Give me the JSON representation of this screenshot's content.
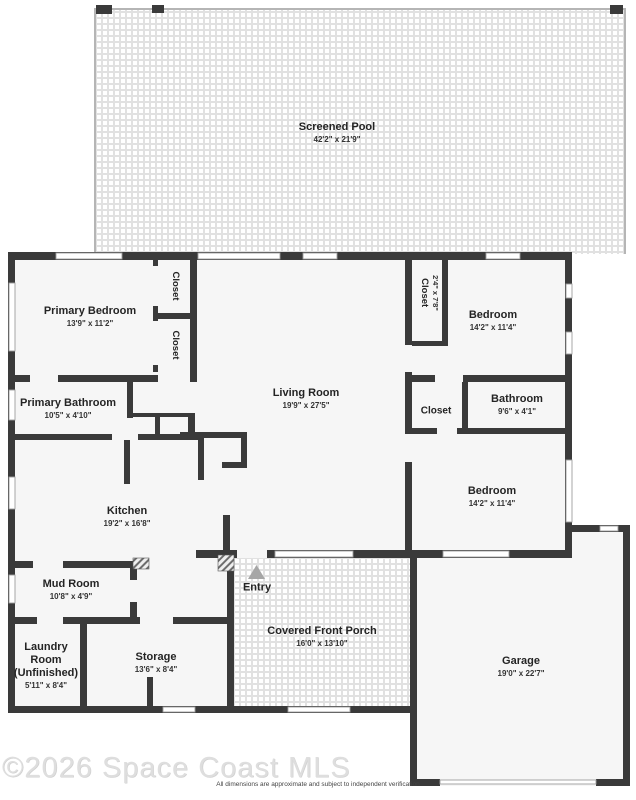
{
  "watermark": "©2026 Space Coast MLS",
  "disclaimer": "All dimensions are approximate and subject to independent verification",
  "rooms": {
    "pool": {
      "name": "Screened Pool",
      "dims": "42'2\" x 21'9\""
    },
    "primary_bedroom": {
      "name": "Primary Bedroom",
      "dims": "13'9\" x 11'2\""
    },
    "closet_primary_a": {
      "name": "Closet"
    },
    "closet_primary_b": {
      "name": "Closet"
    },
    "living_room": {
      "name": "Living Room",
      "dims": "19'9\" x 27'5\""
    },
    "closet_bedroom1": {
      "name": "Closet",
      "dims": "2'4\" x 7'8\""
    },
    "bedroom1": {
      "name": "Bedroom",
      "dims": "14'2\" x 11'4\""
    },
    "primary_bathroom": {
      "name": "Primary Bathroom",
      "dims": "10'5\" x 4'10\""
    },
    "closet_hall": {
      "name": "Closet"
    },
    "bathroom": {
      "name": "Bathroom",
      "dims": "9'6\" x 4'1\""
    },
    "bedroom2": {
      "name": "Bedroom",
      "dims": "14'2\" x 11'4\""
    },
    "kitchen": {
      "name": "Kitchen",
      "dims": "19'2\" x 16'8\""
    },
    "mud_room": {
      "name": "Mud Room",
      "dims": "10'8\" x 4'9\""
    },
    "laundry": {
      "name": "Laundry Room (Unfinished)",
      "dims": "5'11\" x 8'4\""
    },
    "storage": {
      "name": "Storage",
      "dims": "13'6\" x 8'4\""
    },
    "entry": {
      "name": "Entry"
    },
    "porch": {
      "name": "Covered Front Porch",
      "dims": "16'0\" x 13'10\""
    },
    "garage": {
      "name": "Garage",
      "dims": "19'0\" x 22'7\""
    }
  },
  "colors": {
    "wall": "#3a3a3a",
    "room_fill": "#f6f6f6",
    "screen_line": "#b5b5b5"
  }
}
